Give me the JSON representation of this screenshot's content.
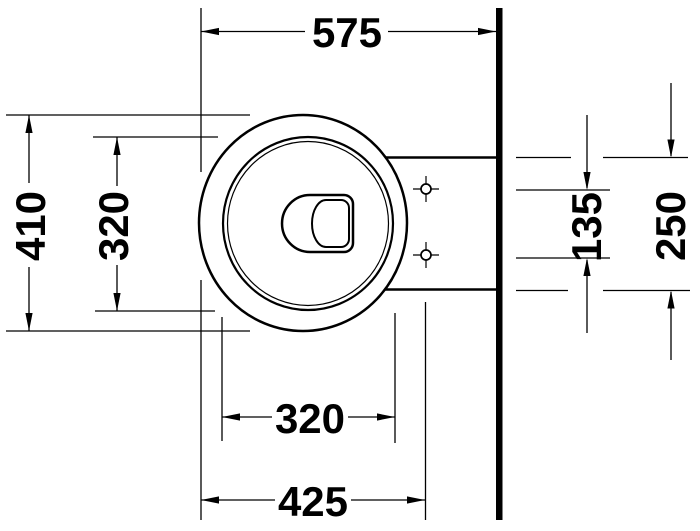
{
  "drawing": {
    "kind": "technical plan view drawing",
    "colors": {
      "line": "#000000",
      "background": "#ffffff"
    },
    "dims": {
      "top": "575",
      "left_outer": "410",
      "left_inner": "320",
      "right_inner": "135",
      "right_outer": "250",
      "bottom_inner": "320",
      "bottom_outer": "425"
    }
  }
}
